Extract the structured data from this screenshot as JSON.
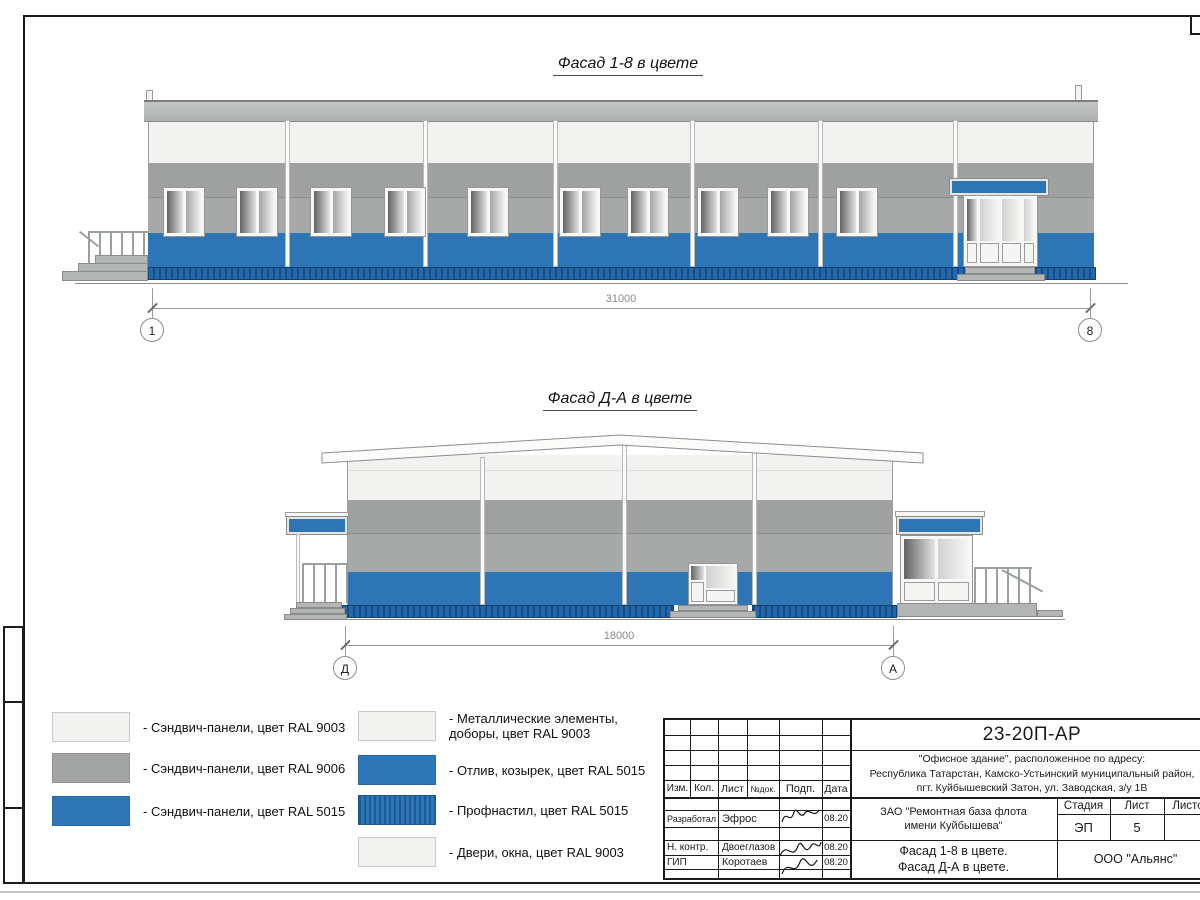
{
  "drawing": {
    "facade1": {
      "title": "Фасад 1-8 в цвете",
      "dim": "31000",
      "axisL": "1",
      "axisR": "8"
    },
    "facade2": {
      "title": "Фасад Д-А в цвете",
      "dim": "18000",
      "axisL": "Д",
      "axisR": "А"
    },
    "legend": {
      "left": [
        {
          "label": "- Сэндвич-панели, цвет RAL 9003"
        },
        {
          "label": "- Сэндвич-панели, цвет RAL 9006"
        },
        {
          "label": "- Сэндвич-панели, цвет RAL 5015"
        }
      ],
      "right": [
        {
          "label": "- Металлические элементы,\nдоборы, цвет RAL 9003"
        },
        {
          "label": "- Отлив, козырек, цвет RAL 5015"
        },
        {
          "label": "- Профнастил, цвет RAL 5015"
        },
        {
          "label": "- Двери, окна, цвет RAL 9003"
        }
      ]
    },
    "stamp": {
      "code": "23-20П-АР",
      "address": "\"Офисное здание\", расположенное по адресу:\nРеспублика Татарстан, Камско-Устьинский муниципальный район,\nпгт. Куйбышевский Затон, ул. Заводская, з/у 1В",
      "cols": {
        "izm": "Изм.",
        "kol": "Кол.",
        "list": "Лист",
        "ndok": "№док.",
        "podp": "Подп.",
        "data": "Дата"
      },
      "rows": [
        {
          "role": "Разработал",
          "name": "Эфрос",
          "date": "08.20"
        },
        {
          "role": "Н. контр.",
          "name": "Двоеглазов",
          "date": "08.20"
        },
        {
          "role": "ГИП",
          "name": "Коротаев",
          "date": "08.20"
        }
      ],
      "client": "ЗАО \"Ремонтная база флота\nимени Куйбышева\"",
      "sheet_title": "Фасад 1-8 в цвете.\nФасад Д-А в цвете.",
      "stage_label": "Стадия",
      "list_label": "Лист",
      "listov_label": "Листов",
      "stage": "ЭП",
      "list": "5",
      "company": "ООО \"Альянс\""
    },
    "colors": {
      "ral9003_white": "#f2f3f0",
      "ral9006_gray": "#a2a5a4",
      "ral5015_blue": "#2e75b5",
      "profnastil_dark_blue": "#1d5b96"
    }
  }
}
